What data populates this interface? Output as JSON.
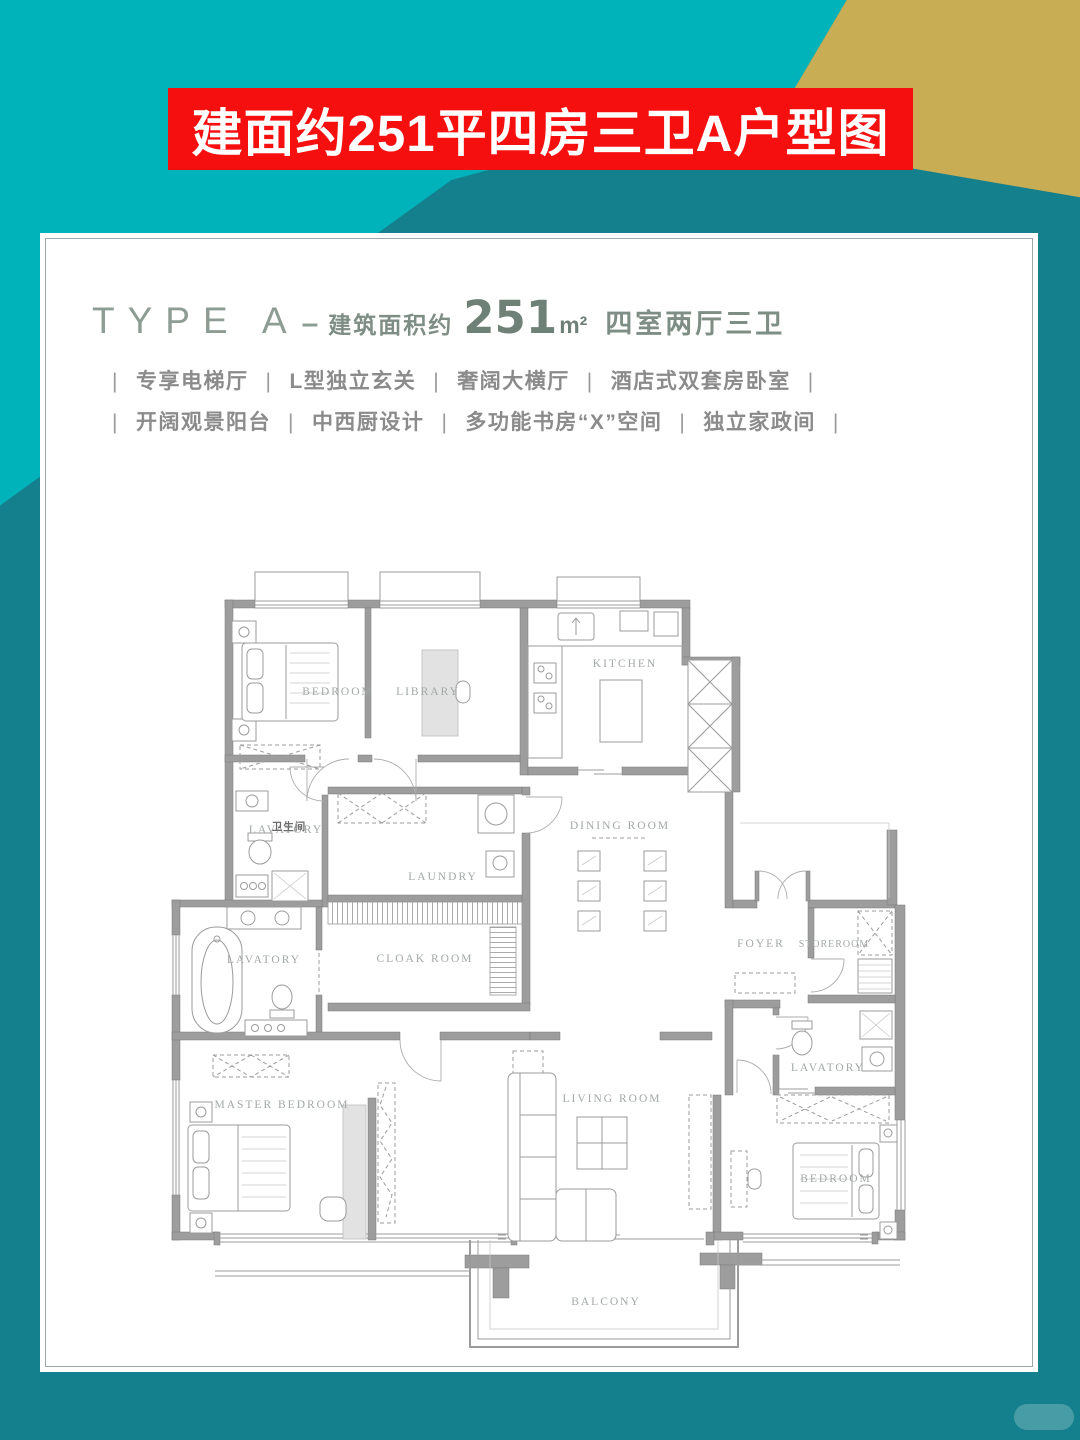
{
  "colors": {
    "bg_dark_teal": "#15808D",
    "bg_bright_teal": "#00B3BA",
    "bg_gold": "#C9AD55",
    "banner_red": "#F50F0F",
    "header_sage": "#8E9D94",
    "plan_wall_gray": "#9D9D9D"
  },
  "banner": {
    "text": "建面约251平四房三卫A户型图"
  },
  "card": {
    "header": {
      "type_label": "TYPE A",
      "separator": "–",
      "area_prefix": "建筑面积约",
      "area_value": "251",
      "area_unit": "m²",
      "rooms_summary": "四室两厅三卫"
    },
    "features": {
      "separator": "|",
      "row1": [
        "专享电梯厅",
        "L型独立玄关",
        "奢阔大横厅",
        "酒店式双套房卧室"
      ],
      "row2": [
        "开阔观景阳台",
        "中西厨设计",
        "多功能书房“X”空间",
        "独立家政间"
      ]
    }
  },
  "floorplan": {
    "rooms": [
      {
        "id": "bedroom-1",
        "label": "BEDROOM",
        "x": 178,
        "y": 140
      },
      {
        "id": "library",
        "label": "LIBRARY",
        "x": 268,
        "y": 140
      },
      {
        "id": "kitchen",
        "label": "KITCHEN",
        "x": 465,
        "y": 112
      },
      {
        "id": "dining-room",
        "label": "DINING ROOM",
        "x": 460,
        "y": 274
      },
      {
        "id": "lavatory-guest",
        "label": "LAVATORY",
        "x": 126,
        "y": 278
      },
      {
        "id": "lavatory-guest-zh",
        "label": "卫生间",
        "x": 129,
        "y": 275,
        "cls": "zh"
      },
      {
        "id": "laundry",
        "label": "LAUNDRY",
        "x": 283,
        "y": 325
      },
      {
        "id": "lavatory-master",
        "label": "LAVATORY",
        "x": 104,
        "y": 408
      },
      {
        "id": "cloak-room",
        "label": "CLOAK ROOM",
        "x": 265,
        "y": 407
      },
      {
        "id": "foyer",
        "label": "FOYER",
        "x": 601,
        "y": 392
      },
      {
        "id": "storeroom",
        "label": "STOREROOM",
        "x": 674,
        "y": 392,
        "cls": "small"
      },
      {
        "id": "lavatory-suite",
        "label": "LAVATORY",
        "x": 668,
        "y": 516
      },
      {
        "id": "master-bedroom",
        "label": "MASTER BEDROOM",
        "x": 122,
        "y": 553
      },
      {
        "id": "living-room",
        "label": "LIVING ROOM",
        "x": 452,
        "y": 547
      },
      {
        "id": "bedroom-2",
        "label": "BEDROOM",
        "x": 676,
        "y": 627
      },
      {
        "id": "balcony",
        "label": "BALCONY",
        "x": 446,
        "y": 750
      }
    ]
  }
}
